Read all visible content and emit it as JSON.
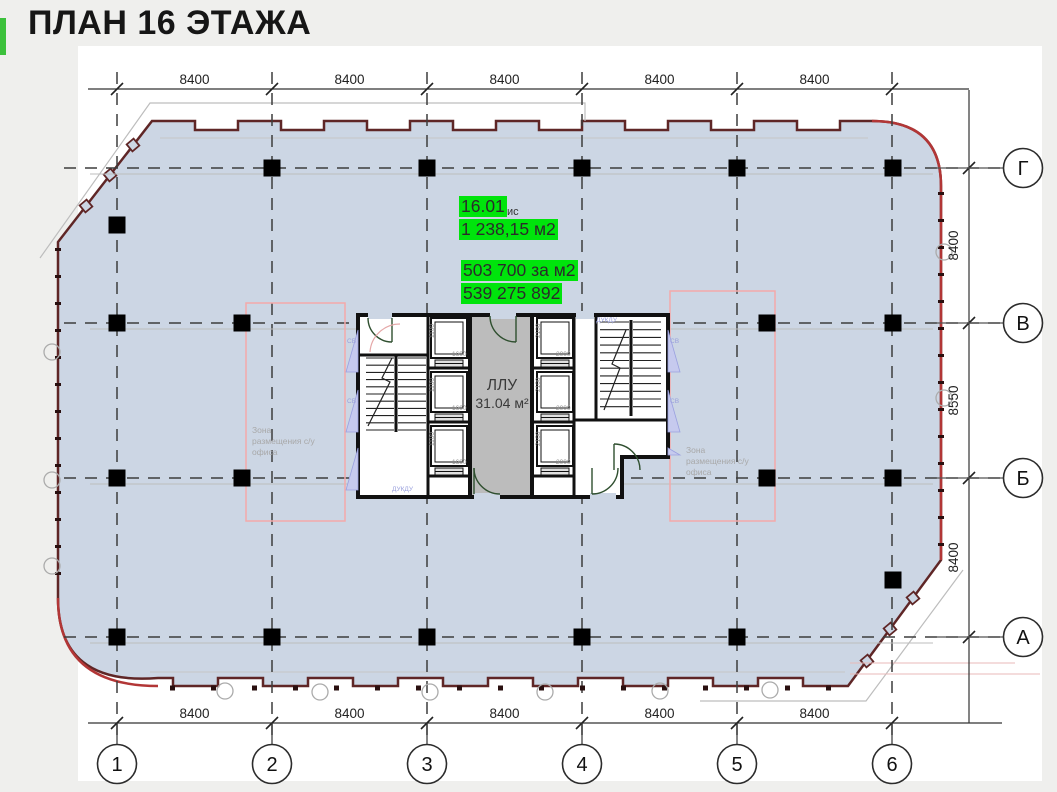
{
  "title": "ПЛАН 16 ЭТАЖА",
  "listing": {
    "unit_number": "16.01",
    "unit_suffix": "ис",
    "area": "1 238,15 м2",
    "price_per_m2": "503 700 за м2",
    "total_price": "539 275 892"
  },
  "core": {
    "lobby_name": "ЛЛУ",
    "lobby_area": "31.04 м²",
    "vent_label": "СВ",
    "duct_label": "ДУКДУ",
    "elevator_left_width": "1100",
    "elevator_left_depth": "1600",
    "elevator_right_width": "2100",
    "elevator_right_depth": "2000"
  },
  "zones": {
    "left": "Зона\nразмещения с/у\nофиса",
    "right": "Зона\nразмещения с/у\nофиса"
  },
  "grid": {
    "columns": [
      "1",
      "2",
      "3",
      "4",
      "5",
      "6"
    ],
    "rows": [
      "Г",
      "В",
      "Б",
      "А"
    ],
    "top_dims": [
      "8400",
      "8400",
      "8400",
      "8400",
      "8400"
    ],
    "bottom_dims": [
      "8400",
      "8400",
      "8400",
      "8400",
      "8400"
    ],
    "right_dims": [
      "8400",
      "8550",
      "8400"
    ]
  },
  "colors": {
    "highlight_green": "#00e40c",
    "tab_green": "#3cc13c",
    "floor_fill": "#ccd6e4",
    "facade_outline": "#5f2626",
    "zone_outline": "#f4a9a9"
  }
}
